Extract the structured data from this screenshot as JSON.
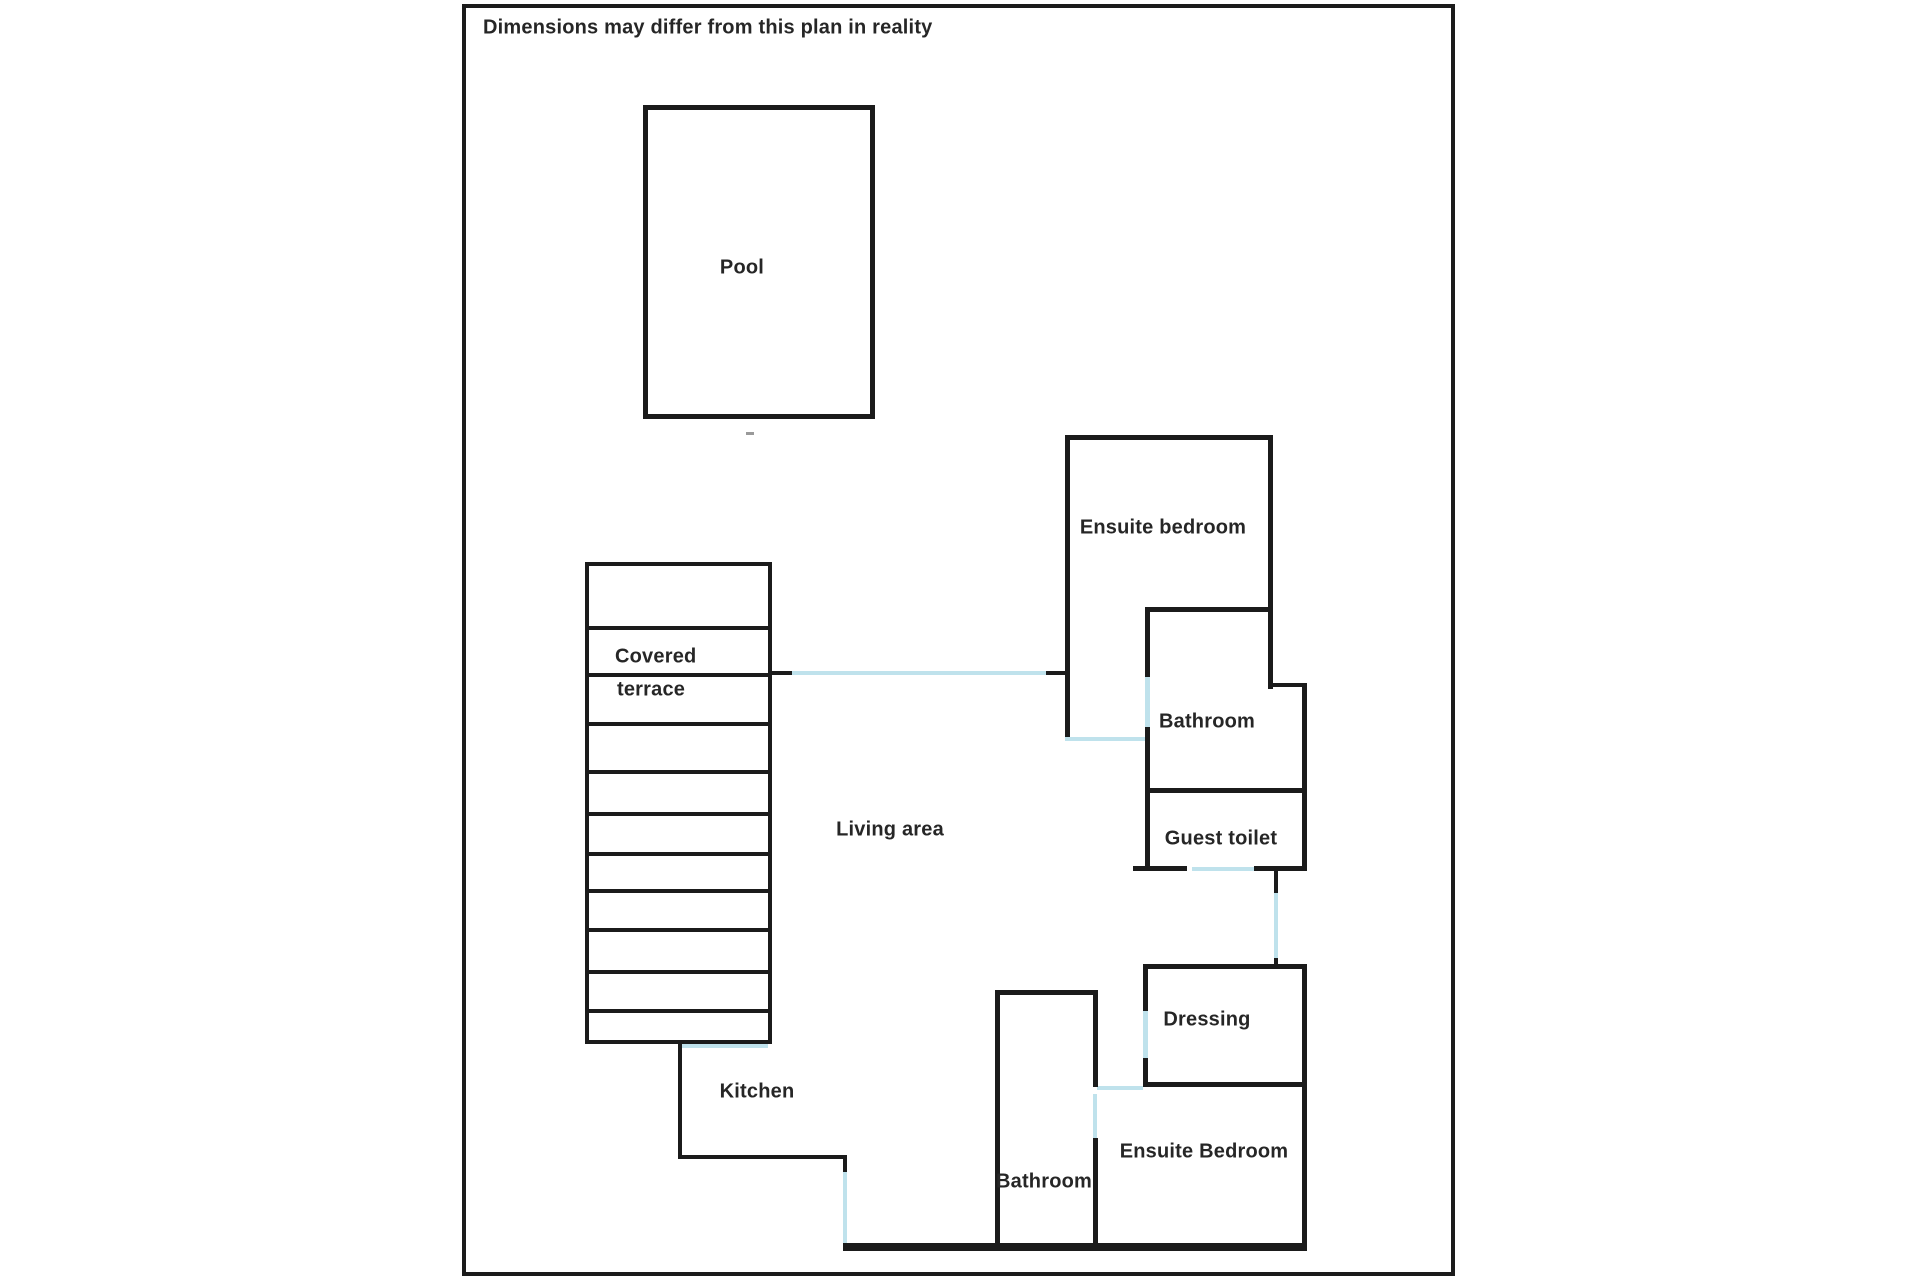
{
  "note": "Dimensions may differ from this plan in reality",
  "colors": {
    "wall": "#1b1b1b",
    "door_opening": "#bfe2ec",
    "text": "#262626",
    "background": "#ffffff"
  },
  "canvas": {
    "width": 1920,
    "height": 1280
  },
  "labels": [
    {
      "name": "pool-label",
      "text": "Pool",
      "x": 742,
      "y": 268
    },
    {
      "name": "covered-terrace-label-line1",
      "text": "Covered",
      "x": 615,
      "y": 657,
      "align": "left"
    },
    {
      "name": "covered-terrace-label-line2",
      "text": "terrace",
      "x": 617,
      "y": 690,
      "align": "left"
    },
    {
      "name": "living-area-label",
      "text": "Living area",
      "x": 890,
      "y": 830
    },
    {
      "name": "ensuite-bedroom-top-label",
      "text": "Ensuite bedroom",
      "x": 1163,
      "y": 528
    },
    {
      "name": "bathroom-top-label",
      "text": "Bathroom",
      "x": 1207,
      "y": 722
    },
    {
      "name": "guest-toilet-label",
      "text": "Guest toilet",
      "x": 1221,
      "y": 839
    },
    {
      "name": "dressing-label",
      "text": "Dressing",
      "x": 1207,
      "y": 1020
    },
    {
      "name": "ensuite-bedroom-bottom-label",
      "text": "Ensuite Bedroom",
      "x": 1204,
      "y": 1152
    },
    {
      "name": "bathroom-bottom-label",
      "text": "Bathroom",
      "x": 1044,
      "y": 1182
    },
    {
      "name": "kitchen-label",
      "text": "Kitchen",
      "x": 757,
      "y": 1092
    }
  ],
  "walls": [
    {
      "name": "outer-border-top",
      "x": 462,
      "y": 4,
      "w": 993,
      "h": 4
    },
    {
      "name": "outer-border-bottom",
      "x": 462,
      "y": 1272,
      "w": 993,
      "h": 4
    },
    {
      "name": "outer-border-left",
      "x": 462,
      "y": 4,
      "w": 4,
      "h": 1272
    },
    {
      "name": "outer-border-right",
      "x": 1451,
      "y": 4,
      "w": 4,
      "h": 1272
    },
    {
      "name": "pool-wall-top",
      "x": 643,
      "y": 105,
      "w": 232,
      "h": 5
    },
    {
      "name": "pool-wall-bottom",
      "x": 643,
      "y": 414,
      "w": 232,
      "h": 5
    },
    {
      "name": "pool-wall-left",
      "x": 643,
      "y": 105,
      "w": 5,
      "h": 314
    },
    {
      "name": "pool-wall-right",
      "x": 870,
      "y": 105,
      "w": 5,
      "h": 314
    },
    {
      "name": "pool-mark",
      "x": 746,
      "y": 432,
      "w": 8,
      "h": 3,
      "kind": "dash"
    },
    {
      "name": "terrace-wall-top",
      "x": 585,
      "y": 562,
      "w": 187,
      "h": 4
    },
    {
      "name": "terrace-wall-left",
      "x": 585,
      "y": 562,
      "w": 4,
      "h": 482
    },
    {
      "name": "terrace-wall-right",
      "x": 768,
      "y": 562,
      "w": 4,
      "h": 482
    },
    {
      "name": "terrace-wall-bottom",
      "x": 585,
      "y": 1040,
      "w": 187,
      "h": 4
    },
    {
      "name": "terrace-slat-1",
      "x": 585,
      "y": 626,
      "w": 187,
      "h": 4
    },
    {
      "name": "terrace-slat-2",
      "x": 585,
      "y": 673,
      "w": 187,
      "h": 4
    },
    {
      "name": "terrace-slat-3",
      "x": 585,
      "y": 722,
      "w": 187,
      "h": 4
    },
    {
      "name": "terrace-slat-4",
      "x": 585,
      "y": 770,
      "w": 187,
      "h": 4
    },
    {
      "name": "terrace-slat-5",
      "x": 585,
      "y": 812,
      "w": 187,
      "h": 4
    },
    {
      "name": "terrace-slat-6",
      "x": 585,
      "y": 852,
      "w": 187,
      "h": 4
    },
    {
      "name": "terrace-slat-7",
      "x": 585,
      "y": 889,
      "w": 187,
      "h": 4
    },
    {
      "name": "terrace-slat-8",
      "x": 585,
      "y": 928,
      "w": 187,
      "h": 4
    },
    {
      "name": "terrace-slat-9",
      "x": 585,
      "y": 970,
      "w": 187,
      "h": 4
    },
    {
      "name": "terrace-slat-10",
      "x": 585,
      "y": 1009,
      "w": 187,
      "h": 4
    },
    {
      "name": "terrace-kitchen-opening",
      "x": 680,
      "y": 1044,
      "w": 88,
      "h": 4,
      "kind": "door"
    },
    {
      "name": "terrace-passage-stub-left",
      "x": 772,
      "y": 671,
      "w": 20,
      "h": 4
    },
    {
      "name": "terrace-passage-opening",
      "x": 792,
      "y": 671,
      "w": 254,
      "h": 4,
      "kind": "door"
    },
    {
      "name": "terrace-passage-stub-right",
      "x": 1046,
      "y": 671,
      "w": 19,
      "h": 4
    },
    {
      "name": "ensuite-top-wall-top",
      "x": 1065,
      "y": 435,
      "w": 208,
      "h": 5
    },
    {
      "name": "ensuite-top-wall-left",
      "x": 1065,
      "y": 435,
      "w": 5,
      "h": 305
    },
    {
      "name": "ensuite-top-wall-right",
      "x": 1268,
      "y": 435,
      "w": 5,
      "h": 254
    },
    {
      "name": "ensuite-top-bathroom-divider",
      "x": 1145,
      "y": 607,
      "w": 128,
      "h": 5
    },
    {
      "name": "ensuite-top-living-opening",
      "x": 1065,
      "y": 737,
      "w": 80,
      "h": 4,
      "kind": "door"
    },
    {
      "name": "bathroom-top-wall-left-upper",
      "x": 1145,
      "y": 607,
      "w": 5,
      "h": 70
    },
    {
      "name": "bathroom-top-door",
      "x": 1145,
      "y": 677,
      "w": 5,
      "h": 50,
      "kind": "door"
    },
    {
      "name": "bathroom-top-wall-left-lower",
      "x": 1145,
      "y": 727,
      "w": 5,
      "h": 65
    },
    {
      "name": "bathroom-top-notch",
      "x": 1268,
      "y": 683,
      "w": 39,
      "h": 4
    },
    {
      "name": "bathroom-top-wall-right",
      "x": 1302,
      "y": 685,
      "w": 5,
      "h": 107
    },
    {
      "name": "bathroom-top-wall-bottom",
      "x": 1145,
      "y": 788,
      "w": 162,
      "h": 5
    },
    {
      "name": "guest-toilet-wall-left",
      "x": 1145,
      "y": 788,
      "w": 5,
      "h": 82
    },
    {
      "name": "guest-toilet-wall-right",
      "x": 1302,
      "y": 788,
      "w": 5,
      "h": 82
    },
    {
      "name": "guest-toilet-bottom-left",
      "x": 1133,
      "y": 866,
      "w": 54,
      "h": 5
    },
    {
      "name": "guest-toilet-door",
      "x": 1192,
      "y": 867,
      "w": 62,
      "h": 4,
      "kind": "door"
    },
    {
      "name": "guest-toilet-bottom-right",
      "x": 1254,
      "y": 866,
      "w": 53,
      "h": 5
    },
    {
      "name": "corridor-stub-top",
      "x": 1274,
      "y": 871,
      "w": 4,
      "h": 22
    },
    {
      "name": "corridor-opening",
      "x": 1274,
      "y": 893,
      "w": 4,
      "h": 67,
      "kind": "door"
    },
    {
      "name": "corridor-stub-bottom",
      "x": 1274,
      "y": 958,
      "w": 4,
      "h": 10
    },
    {
      "name": "dressing-wall-top",
      "x": 1143,
      "y": 964,
      "w": 164,
      "h": 5
    },
    {
      "name": "dressing-wall-left-upper",
      "x": 1143,
      "y": 964,
      "w": 5,
      "h": 47
    },
    {
      "name": "dressing-door",
      "x": 1143,
      "y": 1011,
      "w": 5,
      "h": 47,
      "kind": "door"
    },
    {
      "name": "dressing-wall-left-lower",
      "x": 1143,
      "y": 1058,
      "w": 5,
      "h": 29
    },
    {
      "name": "dressing-wall-right",
      "x": 1302,
      "y": 964,
      "w": 5,
      "h": 123
    },
    {
      "name": "dressing-wall-bottom",
      "x": 1143,
      "y": 1082,
      "w": 164,
      "h": 5
    },
    {
      "name": "ensuite-bottom-top-opening",
      "x": 1097,
      "y": 1086,
      "w": 46,
      "h": 4,
      "kind": "door"
    },
    {
      "name": "ensuite-bottom-wall-right",
      "x": 1302,
      "y": 1082,
      "w": 5,
      "h": 168
    },
    {
      "name": "bathroom-bottom-wall-top",
      "x": 995,
      "y": 990,
      "w": 102,
      "h": 5
    },
    {
      "name": "bathroom-bottom-wall-left",
      "x": 995,
      "y": 990,
      "w": 5,
      "h": 260
    },
    {
      "name": "bedroom-divider-upper",
      "x": 1093,
      "y": 990,
      "w": 5,
      "h": 97
    },
    {
      "name": "bedroom-divider-door",
      "x": 1093,
      "y": 1094,
      "w": 4,
      "h": 44,
      "kind": "door"
    },
    {
      "name": "bedroom-divider-lower",
      "x": 1093,
      "y": 1138,
      "w": 5,
      "h": 110
    },
    {
      "name": "kitchen-wall-left",
      "x": 678,
      "y": 1044,
      "w": 4,
      "h": 115
    },
    {
      "name": "kitchen-wall-bottom",
      "x": 678,
      "y": 1155,
      "w": 169,
      "h": 4
    },
    {
      "name": "kitchen-stub",
      "x": 843,
      "y": 1155,
      "w": 4,
      "h": 17
    },
    {
      "name": "kitchen-opening",
      "x": 843,
      "y": 1172,
      "w": 4,
      "h": 73,
      "kind": "door"
    },
    {
      "name": "south-exterior-wall",
      "x": 843,
      "y": 1243,
      "w": 464,
      "h": 8
    }
  ]
}
